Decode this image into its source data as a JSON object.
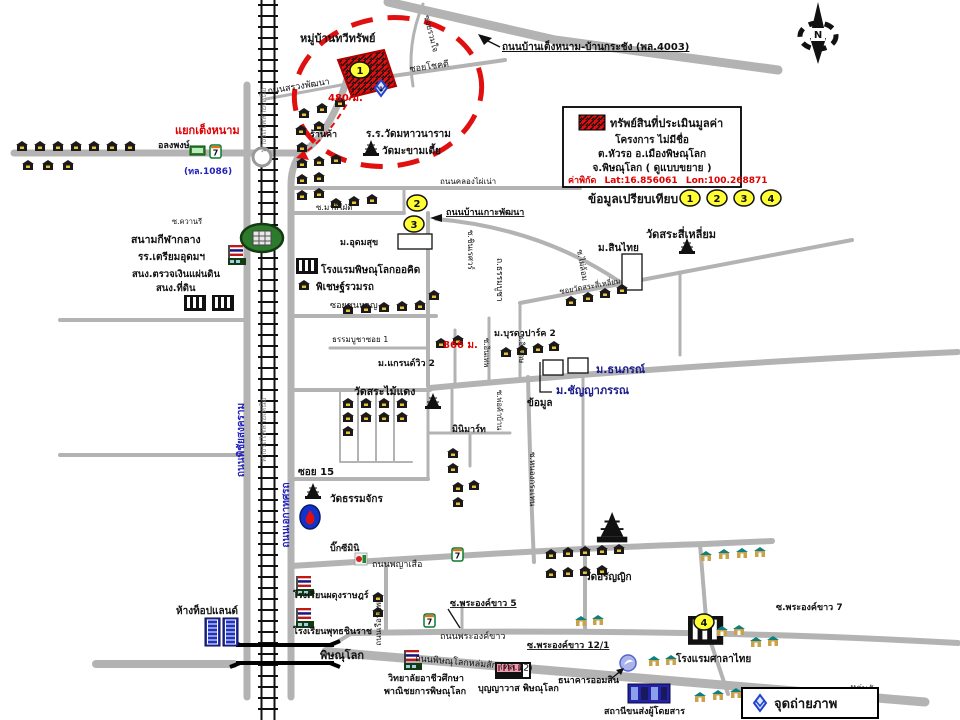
{
  "canvas": {
    "width": 960,
    "height": 720,
    "background": "#ffffff"
  },
  "colors": {
    "road": "#b3b3b3",
    "road_label_blue": "#2222bb",
    "highlight_red": "#e00000",
    "marker_yellow": "#ffff33",
    "photo_blue": "#2244cc",
    "railway_black": "#111111"
  },
  "compass": {
    "n": "N"
  },
  "legend": {
    "line1": "ทรัพย์สินที่ประเมินมูลค่า",
    "line2": "โครงการ ไม่มีชื่อ",
    "line3": "ต.หัวรอ อ.เมืองพิษณุโลก",
    "line4": "จ.พิษณุโลก ( ดูแบบขยาย )",
    "coord_label": "ค่าพิกัด",
    "lat": "Lat:16.856061",
    "lon": "Lon:100.268871"
  },
  "comparison": {
    "label": "ข้อมูลเปรียบเทียบ",
    "points": [
      "1",
      "2",
      "3",
      "4"
    ]
  },
  "photo_legend": {
    "label": "จุดถ่ายภาพ"
  },
  "markers": {
    "m1": "1",
    "m2": "2",
    "m3": "3",
    "m4": "4",
    "photo1": "1",
    "seven": "7"
  },
  "labels": {
    "village": "หมู่บ้านทวีทรัพย์",
    "road_sruang": "ถนนสรวงพัฒนา",
    "soi_ruamjai": "ซอยรวมใจ",
    "soi_chokdee": "ซอยโชคดี",
    "dist480": "480 ม.",
    "road_tengnam": "ถนนบ้านเต็งหนาม-บ้านกระชัง (พล.4003)",
    "shop": "ร้านค้า",
    "school_mahawanaram": "ร.ร.วัดมหาวนาราม",
    "wat_makhamtia": "วัดมะขามเตี้ย",
    "junction_tengnam": "แยกเต็งหนาม",
    "alongpong": "อลงพงษ์",
    "route1086": "(ทล.1086)",
    "soi_malee": "ซ.มาลีใฝ่ดี",
    "m_udomsuk": "ม.อุดมสุข",
    "road_klongpainao": "ถนนคลองไผ่เน่า",
    "road_bankoh": "ถนนบ้านเกาะพัฒนา",
    "soi_kwanree": "ซ.ควานรี",
    "stadium": "สนามกีฬากลาง",
    "school_triamudom": "รร.เตรียมอุดมฯ",
    "audit_office": "สนง.ตรวจเงินแผ่นดิน",
    "land_office": "สนง.ที่ดิน",
    "hotel_orchid": "โรงแรมพิษณุโลกออคิด",
    "pichet_ruamrot": "พิเชษฐ์รวมรถ",
    "soi_chunhan": "ซอยชุนหาญ",
    "thammabucha_soi1": "ธรรมบูชาซอย 1",
    "railway": "ทางรถไฟสายเหนือ",
    "road_phichaisongkram": "ถนนพิชัยสงคราม",
    "road_ekathotsarot": "ถนนเอกาทศรถ",
    "road_thammabucha": "ถ.ธรรมบูชา",
    "soi_chinnaret": "ซ.ชินเรศวร์",
    "wat_srasiliam": "วัดสระสี่เหลี่ยม",
    "m_sinthai": "ม.สินไทย",
    "soi_watsrasiliam": "ซอยวัดสระสี่เหลี่ยม",
    "soi_pailom": "ซ.ไผ่ล้อม",
    "m_buradapark": "ม.บุรดาปาร์ค 2",
    "dist866": "866 ม.",
    "m_grandview": "ม.แกรนด์วิว 2",
    "wat_sramaidaeng": "วัดสระไม้แดง",
    "m_thanaporn": "ม.ธนภรณ์",
    "m_chanyapan": "ม.ชัญญาภรรณ",
    "khomun": "ข้อมูล",
    "minimart": "มินิมาร์ท",
    "soi_inthep": "ซ.อินเทพ",
    "soi_inket": "ซ.อินเกษ",
    "soi_pokaban": "ซ.พ่อค้าบ้าน",
    "soi15": "ซอย 15",
    "wat_thammachak": "วัดธรรมจักร",
    "bigc_mini": "บิ๊กซีมินิ",
    "road_payasuea": "ถนนพญาเสือ",
    "soi_nongkraten": "ซ.หนองกระเทน",
    "road_rueanpae": "ถนนเรือนแพ",
    "wat_aranyik": "วัดอรัญญิก",
    "topland": "ห้างท็อปแลนด์",
    "school_phadungrat": "โรงเรียนผดุงราษฎร์",
    "school_phutthachinnarat": "โรงเรียนพุทธชินราช",
    "phitsanulok": "พิษณุโลก",
    "soi_phraongkhao5": "ซ.พระองค์ขาว 5",
    "road_phraongkhao": "ถนนพระองค์ขาว",
    "soi_phraongkhao121": "ซ.พระองค์ขาว 12/1",
    "soi_phraongkhao7": "ซ.พระองค์ขาว 7",
    "hotel_salathai": "โรงแรมศาลาไทย",
    "bank_omsin": "ธนาคารออมสิน",
    "lomsak": "หล่มสัก",
    "hwy12": "ถนนพิษณุโลกหล่มสัก (ทล.12)",
    "college_line1": "วิทยาลัยอาชีวศึกษา",
    "college_line2": "พาณิชยการพิษณุโลก",
    "boonyawat": "บุญญาวาส พิษณุโลก",
    "bus_station": "สถานีขนส่งผู้โดยสาร"
  }
}
